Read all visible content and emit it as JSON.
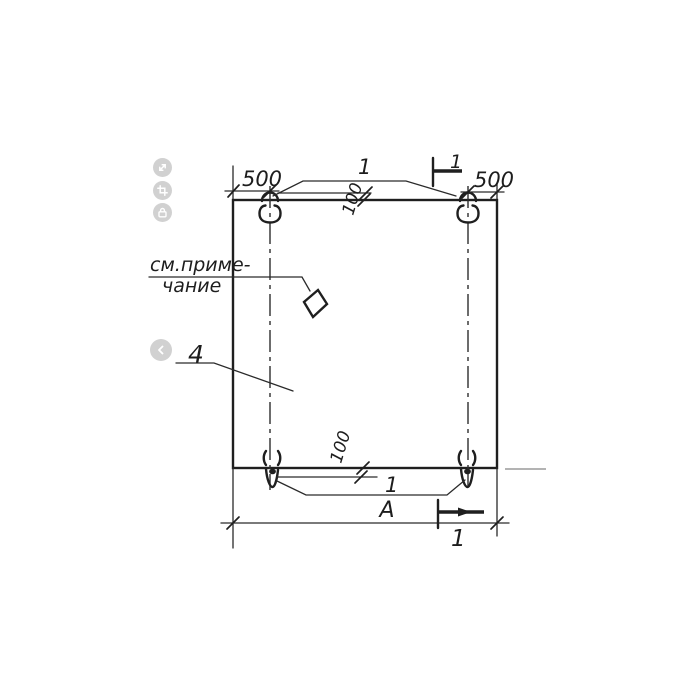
{
  "app": {
    "background": "#ffffff",
    "ink_color": "#1f1f1f",
    "control_color": "#c9c9c9"
  },
  "toolbar": {
    "buttons": [
      {
        "icon": "expand-icon"
      },
      {
        "icon": "crop-icon"
      },
      {
        "icon": "lock-icon"
      }
    ]
  },
  "nav": {
    "back_icon": "chevron-left-icon"
  },
  "drawing": {
    "kind": "precast panel plan view with lifting loops",
    "labels": {
      "dim_left_500": "500",
      "dim_right_500": "500",
      "dim_top_100": "100",
      "dim_bottom_100": "100",
      "callout_top_loops": "1",
      "callout_bottom_loops": "1",
      "section_top": "1",
      "section_bottom": "1",
      "note_line1": "см.приме-",
      "note_line2": "чание",
      "part_label": "4",
      "overall_width": "А"
    }
  }
}
